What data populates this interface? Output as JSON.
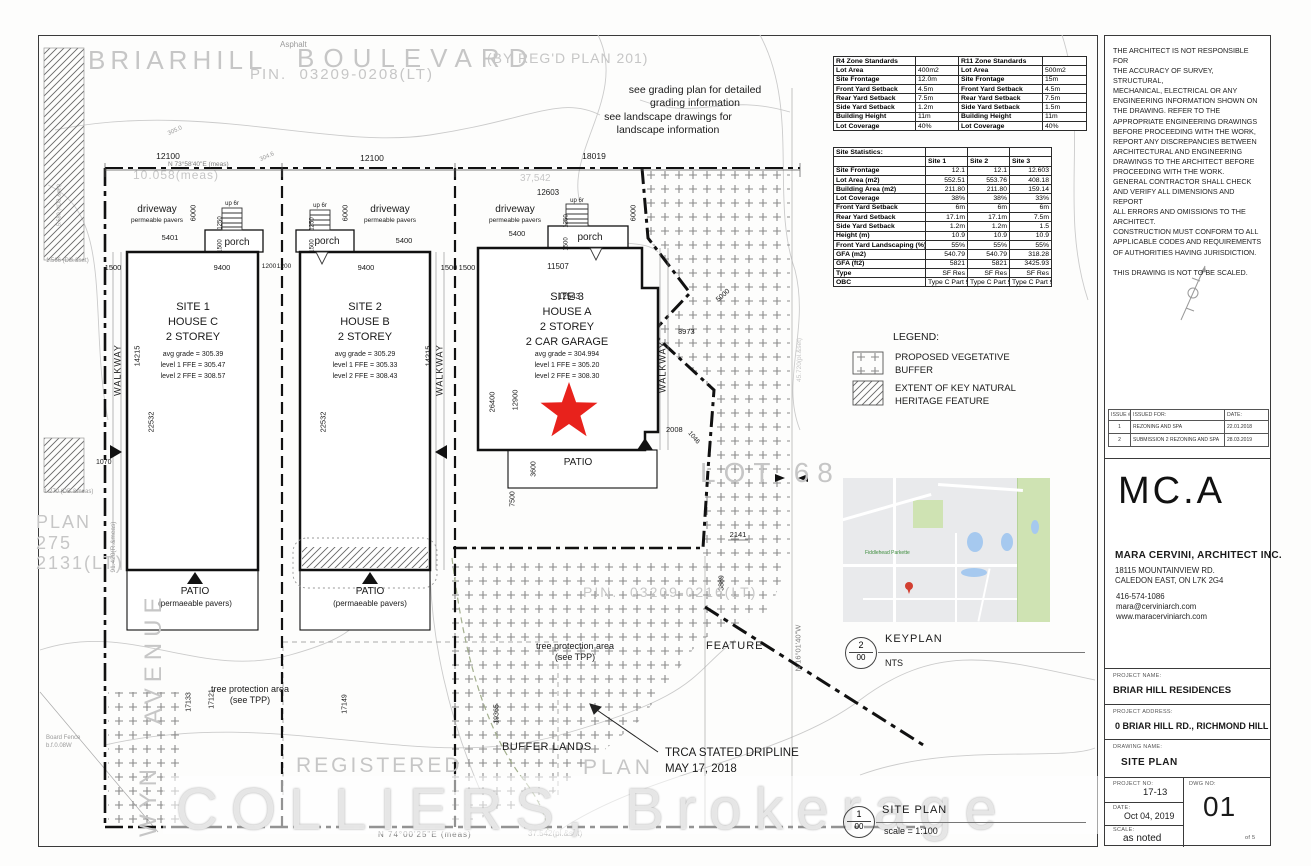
{
  "street": {
    "briarhill": "BRIARHILL",
    "boulevard": "BOULEVARD",
    "regd": "(BY REG'D PLAN 201)",
    "pin": "PIN.  03209-0208(LT)",
    "asphalt": "Asphalt"
  },
  "notes": {
    "grading": "see grading plan for detailed\ngrading information",
    "landscape": "see landscape drawings for\nlandscape information"
  },
  "survey": {
    "bearing_top": "N 73°58'40\"E (meas)",
    "meas10058": "10.058(meas)",
    "meas37542": "37,542",
    "lot68": "LOT 68",
    "pin_bottom": "PIN.  03209-0216(LT)",
    "registered": "REGISTERED",
    "plan_word": "PLAN",
    "plan_block": "PLAN\n275\n2131(LT)",
    "avenue": "AVENUE",
    "wyn": "WYN",
    "board_fence": "Board  Fence\nb.f.0.08W",
    "r_meas": "91.420(R.&meas)",
    "pl_set_right": "45.720(pl.&set)",
    "bearing_right": "N 16°01'40\"W",
    "bearing_bottom": "N 74°00'25\"E (meas)",
    "pl_set_bottom": "37.542(pl.&set)",
    "db1": "1.566 (DB.&set)",
    "db2": "1.270 (DB.&meas)",
    "db3": "5.580 (4DB.&set)",
    "c305": "305.0",
    "c304": "304.6"
  },
  "labels": {
    "driveway": "driveway",
    "pavers": "permeable pavers",
    "porch": "porch",
    "up6r": "up 6r",
    "walkway": "WALKWAY",
    "patio": "PATIO",
    "patio_pavers": "(permaeable pavers)",
    "buffer_lands": "BUFFER LANDS",
    "tpp": "tree protection area\n(see TPP)",
    "trca": "TRCA STATED DRIPLINE\nMAY 17, 2018",
    "feature": "FEATURE"
  },
  "dims": {
    "d12100": "12100",
    "d18019": "18019",
    "d12603": "12603",
    "d9400": "9400",
    "d1200": "1200",
    "d1500": "1500",
    "d5401": "5401",
    "d5400": "5400",
    "d6000": "6000",
    "d1250": "1250",
    "d14215": "14215",
    "d22532": "22532",
    "d11507": "11507",
    "d12543": "12543",
    "d26400": "26400",
    "d12900": "12900",
    "d3600": "3600",
    "d7500": "7500",
    "d2008": "2008",
    "d3973": "3973",
    "d5000": "5000",
    "d1070": "1070",
    "d1046": "1046",
    "d2141": "2141",
    "d3889": "3889",
    "d17133": "17133",
    "d17121": "17121",
    "d17149": "17149",
    "d19365": "19365"
  },
  "sites": [
    {
      "title": "SITE 1\nHOUSE C\n2 STOREY",
      "grades": "avg grade = 305.39\nlevel 1 FFE = 305.47\nlevel 2 FFE = 308.57"
    },
    {
      "title": "SITE 2\nHOUSE B\n2 STOREY",
      "grades": "avg grade = 305.29\nlevel 1 FFE = 305.33\nlevel 2 FFE = 308.43"
    },
    {
      "title": "SITE 3\nHOUSE A\n2 STOREY\n2 CAR GARAGE",
      "grades": "avg grade = 304.994\nlevel 1 FFE = 305.20\nlevel 2 FFE = 308.30"
    }
  ],
  "tables": {
    "r4": {
      "title": "R4 Zone Standards",
      "rows": [
        [
          "Lot Area",
          "400m2"
        ],
        [
          "Site Frontage",
          "12.0m"
        ],
        [
          "Front Yard Setback",
          "4.5m"
        ],
        [
          "Rear Yard Setback",
          "7.5m"
        ],
        [
          "Side Yard Setback",
          "1.2m"
        ],
        [
          "Building Height",
          "11m"
        ],
        [
          "Lot Coverage",
          "40%"
        ]
      ]
    },
    "r11": {
      "title": "R11 Zone Standards",
      "rows": [
        [
          "Lot Area",
          "500m2"
        ],
        [
          "Site Frontage",
          "15m"
        ],
        [
          "Front Yard Setback",
          "4.5m"
        ],
        [
          "Rear Yard Setback",
          "7.5m"
        ],
        [
          "Side Yard Setback",
          "1.5m"
        ],
        [
          "Building Height",
          "11m"
        ],
        [
          "Lot Coverage",
          "40%"
        ]
      ]
    },
    "stats": {
      "title": "Site Statistics:",
      "cols": [
        "",
        "Site 1",
        "Site 2",
        "Site 3"
      ],
      "rows": [
        [
          "Site Frontage",
          "12.1",
          "12.1",
          "12.603"
        ],
        [
          "Lot Area  (m2)",
          "552.51",
          "553.76",
          "408.18"
        ],
        [
          "Building Area (m2)",
          "211.80",
          "211.80",
          "159.14"
        ],
        [
          "Lot Coverage",
          "38%",
          "38%",
          "33%"
        ],
        [
          "Front Yard Setback",
          "6m",
          "6m",
          "6m"
        ],
        [
          "Rear Yard Setback",
          "17.1m",
          "17.1m",
          "7.5m"
        ],
        [
          "Side Yard Setback",
          "1.2m",
          "1.2m",
          "1.5"
        ],
        [
          "Height (m)",
          "10.9",
          "10.9",
          "10.9"
        ],
        [
          "Front Yard Landscaping (%)",
          "55%",
          "55%",
          "55%"
        ],
        [
          "GFA (m2)",
          "540.79",
          "540.79",
          "318.28"
        ],
        [
          "GFA (ft2)",
          "5821",
          "5821",
          "3425.93"
        ],
        [
          "Type",
          "SF Res",
          "SF Res",
          "SF Res"
        ],
        [
          "OBC",
          "Type C Part 9",
          "Type C Part 9",
          "Type C Part 9"
        ]
      ]
    }
  },
  "legend": {
    "title": "LEGEND:",
    "item1": "PROPOSED VEGETATIVE\nBUFFER",
    "item2": "EXTENT OF KEY NATURAL\nHERITAGE FEATURE"
  },
  "refs": {
    "keyplan": {
      "num": "2",
      "sheet": "00",
      "label": "KEYPLAN",
      "scale": "NTS"
    },
    "siteplan": {
      "num": "1",
      "sheet": "00",
      "label": "SITE PLAN",
      "scale": "scale = 1:100"
    }
  },
  "keyplan": {
    "parkette": "Fiddlehead Parkette"
  },
  "watermark": "COLLIERS, Brokerage",
  "titleblock": {
    "disclaimer": "THE ARCHITECT IS NOT RESPONSIBLE FOR\nTHE ACCURACY OF SURVEY, STRUCTURAL,\nMECHANICAL, ELECTRICAL OR ANY\nENGINEERING INFORMATION SHOWN ON\nTHE DRAWING.  REFER TO THE\nAPPROPRIATE ENGINEERING DRAWINGS\nBEFORE PROCEEDING WITH THE WORK,\nREPORT ANY DISCREPANCIES BETWEEN\nARCHITECTURAL AND ENGINEERING\nDRAWINGS TO THE ARCHITECT BEFORE\nPROCEEDING WITH THE WORK.\nGENERAL CONTRACTOR SHALL CHECK\nAND VERIFY ALL DIMENSIONS AND REPORT\nALL ERRORS AND OMISSIONS TO THE\nARCHITECT.\nCONSTRUCTION MUST CONFORM TO ALL\nAPPLICABLE CODES AND REQUIREMENTS\nOF AUTHORITIES HAVING JURISDICTION.\n\nTHIS DRAWING IS NOT TO BE SCALED.",
    "issue_headers": [
      "ISSUE #",
      "ISSUED FOR:",
      "DATE:"
    ],
    "issues": [
      [
        "1",
        "REZONING  AND SPA",
        "22.01.2018"
      ],
      [
        "2",
        "SUBMISSION 2 REZONING  AND SPA",
        "28.03.2019"
      ]
    ],
    "firm": "MC.A",
    "firm_name": "MARA CERVINI, ARCHITECT INC.",
    "address1": "18115 MOUNTAINVIEW RD.",
    "address2": "CALEDON EAST, ON L7K 2G4",
    "phone": "416-574-1086",
    "email": "mara@cerviniarch.com",
    "web": "www.maracerviniarch.com",
    "project_name_label": "PROJECT NAME:",
    "project_name": "BRIAR HILL RESIDENCES",
    "project_address_label": "PROJECT ADDRESS:",
    "project_address": "0 BRIAR HILL RD., RICHMOND HILL",
    "drawing_name_label": "DRAWING NAME:",
    "drawing_name": "SITE PLAN",
    "project_no_label": "PROJECT NO:",
    "project_no": "17-13",
    "date_label": "DATE:",
    "date": "Oct 04, 2019",
    "scale_label": "SCALE:",
    "scale": "as noted",
    "dwg_label": "DWG NO:",
    "dwg_no": "01",
    "sheet": "of 5"
  },
  "colors": {
    "star_red": "#e8221c",
    "map_green": "#cfe3b3",
    "map_water": "#a6c9ef",
    "map_bg": "#e9eaec",
    "pin_red": "#d23f31"
  }
}
